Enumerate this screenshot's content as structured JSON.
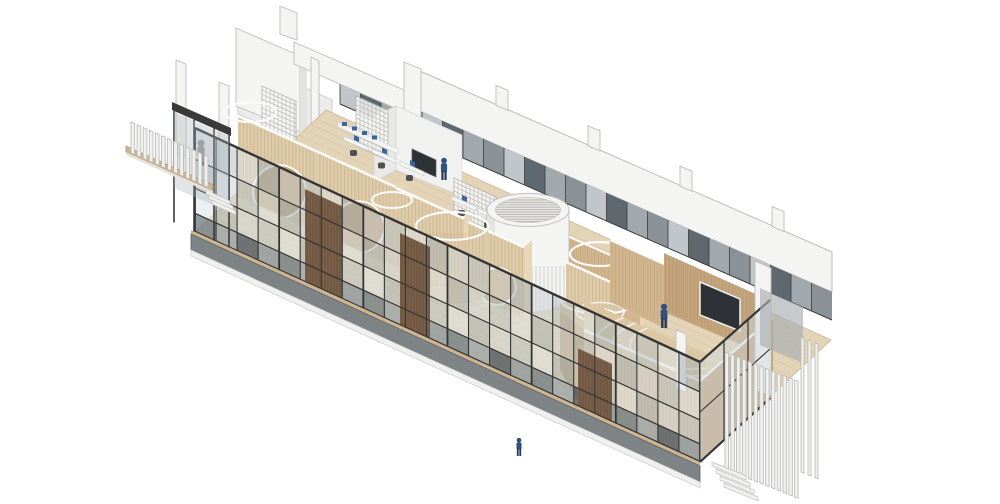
{
  "scene": {
    "kind": "axonometric-architectural-rendering",
    "labels": {
      "building": "long-glazed-pavilion",
      "left_fence": "vertical-louver-screen-left",
      "right_fence": "vertical-louver-screen-right",
      "drum": "cylindrical-louvered-stair-drum",
      "pods": "curved-timber-pods-with-circular-openings",
      "facade": "black-mullion-glazed-facade",
      "rear_band": "white-parapet-beam",
      "auditorium": "tiered-timber-room-with-projection-screen",
      "meeting_room": "white-meeting-room-with-display",
      "figures": "human-figures"
    },
    "figure_count": 4
  },
  "colors": {
    "background": "#ffffff",
    "white_surface": "#f4f4f3",
    "white_soft": "#ececea",
    "white_edge": "#bdbdbb",
    "concrete_side": "#e2e2e0",
    "rim_white": "#fbfbfa",
    "glass_light": "#cfd6d9",
    "glass_mid": "#aab4b9",
    "glass_dark": "#4e575f",
    "glass_slate": "#7d868c",
    "mullion": "#343434",
    "plinth": "#7e8386",
    "plinth_dark": "#5d6265",
    "wood_light": "#decba9",
    "wood_mid": "#d0b58e",
    "wood_dark": "#c2a27a",
    "wood_grain": "#b3946c",
    "floor": "#e3d4b8",
    "floor_line": "#d5c3a4",
    "deck": "#cdb493",
    "batten": "#7c614a",
    "batten_line": "#5a4634",
    "fence_white": "#f0f0ef",
    "fence_edge": "#b7b7b5",
    "drum_white": "#f4f4f3",
    "drum_shade": "#e0e0de",
    "slat_line": "#b5b3ae",
    "lattice": "#b0b0ae",
    "lattice_fill": "#f8f8f7",
    "person_navy": "#31507c",
    "person_dark": "#24395a",
    "silhouette": "#4e4e52",
    "screen_dark": "#2e3237",
    "monitor_blue": "#3f6496",
    "chair_dark": "#4f4f4f",
    "scrim_gray": "#a7adb1"
  }
}
